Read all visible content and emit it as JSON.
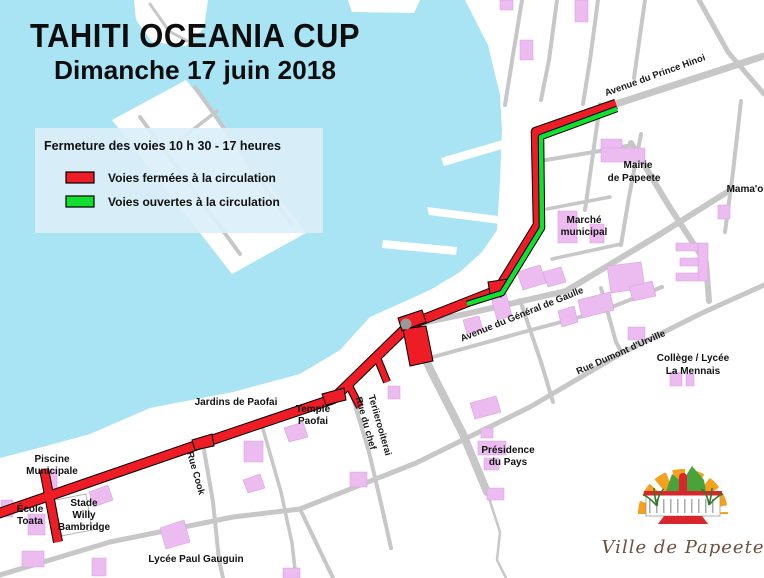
{
  "title": {
    "line1": "TAHITI OCEANIA CUP",
    "line2": "Dimanche 17 juin 2018"
  },
  "legend": {
    "heading": "Fermeture des voies 10 h 30 - 17 heures",
    "items": [
      {
        "label": "Voies fermées à la circulation",
        "color": "#ee1c24"
      },
      {
        "label": "Voies ouvertes à la circulation",
        "color": "#12e02e"
      }
    ]
  },
  "map": {
    "streets": {
      "prince_hinoi": "Avenue du Prince Hinoi",
      "general_de_gaulle": "Avenue du Général de Gaulle",
      "dumont_durville": "Rue Dumont d'Urville",
      "rue_cook": "Rue Cook",
      "rue_du_chef_1": "Rue du chef",
      "rue_du_chef_2": "Teriierooiterai"
    },
    "places": {
      "mairie_1": "Mairie",
      "mairie_2": "de Papeete",
      "mamao": "Mama'o",
      "marche_1": "Marché",
      "marche_2": "municipal",
      "college_1": "Collège / Lycée",
      "college_2": "La Mennais",
      "jardins": "Jardins de Paofai",
      "temple_1": "Temple",
      "temple_2": "Paofai",
      "presidence_1": "Présidence",
      "presidence_2": "du Pays",
      "piscine_1": "Piscine",
      "piscine_2": "Municipale",
      "ecole_1": "École",
      "ecole_2": "Toata",
      "stade_1": "Stade",
      "stade_2": "Willy",
      "stade_3": "Bambridge",
      "lycee_gauguin": "Lycée Paul Gauguin"
    }
  },
  "logo": {
    "text": "Ville de Papeete"
  },
  "colors": {
    "water": "#a9e4f5",
    "land": "#ffffff",
    "road": "#c7c7c7",
    "building": "#ecbbf0",
    "closed_route": "#ee1c24",
    "open_route": "#12e02e",
    "college_label": "#993399",
    "legend_box": "rgba(219,239,249,0.92)"
  }
}
